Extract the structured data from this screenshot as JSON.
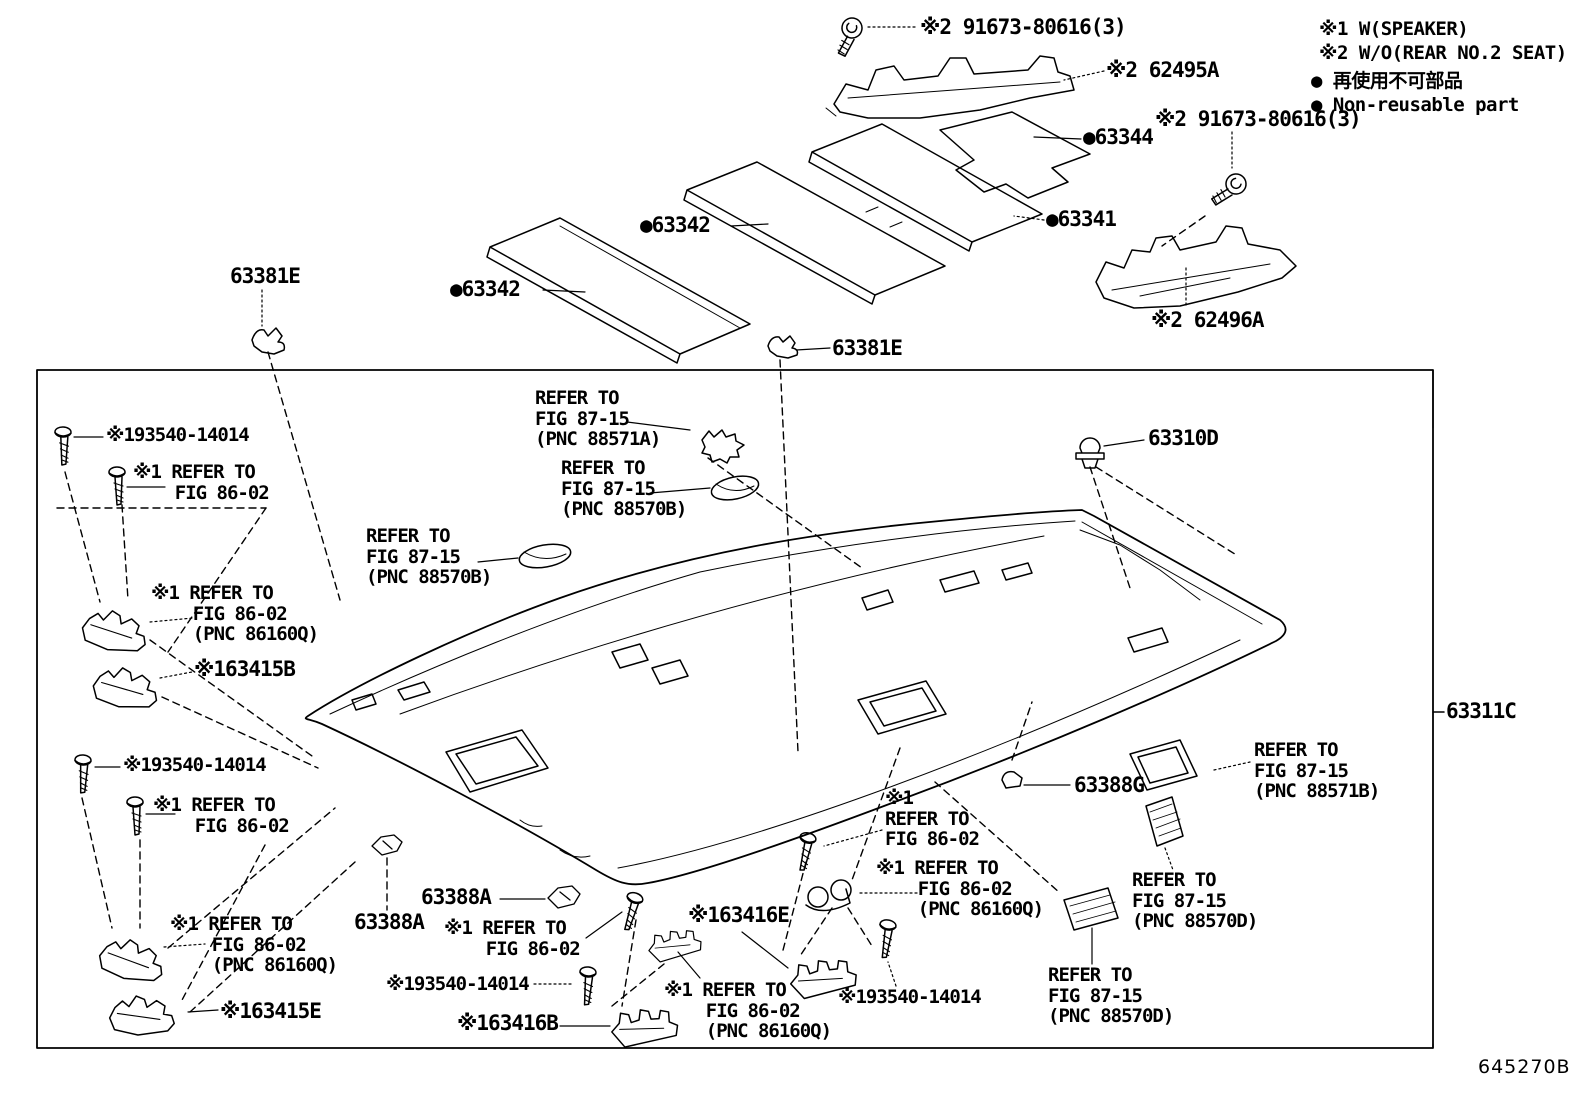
{
  "page": {
    "background": "#ffffff",
    "line_color": "#000000",
    "footer_code": "645270B"
  },
  "legend": {
    "note1": "※1 W(SPEAKER)",
    "note2": "※2 W/O(REAR NO.2 SEAT)",
    "nonreusable_jp": "● 再使用不可部品",
    "nonreusable_en": "● Non-reusable part"
  },
  "callouts": [
    {
      "id": "bolt-91673-top",
      "text": "※2 91673-80616(3)"
    },
    {
      "id": "bracket-62495A",
      "text": "※2 62495A"
    },
    {
      "id": "pad-63344",
      "text": "●63344"
    },
    {
      "id": "bolt-91673-right",
      "text": "※2 91673-80616(3)"
    },
    {
      "id": "pad-63342-mid",
      "text": "●63342"
    },
    {
      "id": "pad-63341",
      "text": "●63341"
    },
    {
      "id": "clip-63381E-left",
      "text": "63381E"
    },
    {
      "id": "pad-63342-left",
      "text": "●63342"
    },
    {
      "id": "bracket-62496A",
      "text": "※2 62496A"
    },
    {
      "id": "clip-63381E-mid",
      "text": "63381E"
    },
    {
      "id": "refer-88571A",
      "text": "REFER TO\nFIG 87-15\n(PNC 88571A)"
    },
    {
      "id": "refer-88570B-a",
      "text": "REFER TO\nFIG 87-15\n(PNC 88570B)"
    },
    {
      "id": "refer-88570B-b",
      "text": "REFER TO\nFIG 87-15\n(PNC 88570B)"
    },
    {
      "id": "clip-63310D",
      "text": "63310D"
    },
    {
      "id": "screw-193540-ul",
      "text": "※193540-14014"
    },
    {
      "id": "refer-8602-ul",
      "text": "※1 REFER TO\n    FIG 86-02"
    },
    {
      "id": "refer-86160Q-ul",
      "text": "※1 REFER TO\n    FIG 86-02\n    (PNC 86160Q)"
    },
    {
      "id": "part-63415B",
      "text": "※163415B"
    },
    {
      "id": "assy-63311C",
      "text": "63311C"
    },
    {
      "id": "refer-88571B",
      "text": "REFER TO\nFIG 87-15\n(PNC 88571B)"
    },
    {
      "id": "clip-63388G",
      "text": "63388G"
    },
    {
      "id": "refer-8602-center",
      "text": "※1\nREFER TO\nFIG 86-02"
    },
    {
      "id": "refer-86160Q-center",
      "text": "※1 REFER TO\n    FIG 86-02\n    (PNC 86160Q)"
    },
    {
      "id": "clip-63388A-a",
      "text": "63388A"
    },
    {
      "id": "clip-63388A-b",
      "text": "63388A"
    },
    {
      "id": "refer-8602-bc",
      "text": "※1 REFER TO\n    FIG 86-02"
    },
    {
      "id": "screw-193540-bc",
      "text": "※193540-14014"
    },
    {
      "id": "part-63416E",
      "text": "※163416E"
    },
    {
      "id": "refer-86160Q-bottom",
      "text": "※1 REFER TO\n    FIG 86-02\n    (PNC 86160Q)"
    },
    {
      "id": "screw-193540-br",
      "text": "※193540-14014"
    },
    {
      "id": "part-63416B",
      "text": "※163416B"
    },
    {
      "id": "part-63415E",
      "text": "※163415E"
    },
    {
      "id": "refer-88570D-a",
      "text": "REFER TO\nFIG 87-15\n(PNC 88570D)"
    },
    {
      "id": "refer-88570D-b",
      "text": "REFER TO\nFIG 87-15\n(PNC 88570D)"
    },
    {
      "id": "screw-193540-ll",
      "text": "※193540-14014"
    },
    {
      "id": "refer-8602-ll",
      "text": "※1 REFER TO\n    FIG 86-02"
    },
    {
      "id": "refer-86160Q-ll",
      "text": "※1 REFER TO\n    FIG 86-02\n    (PNC 86160Q)"
    }
  ]
}
